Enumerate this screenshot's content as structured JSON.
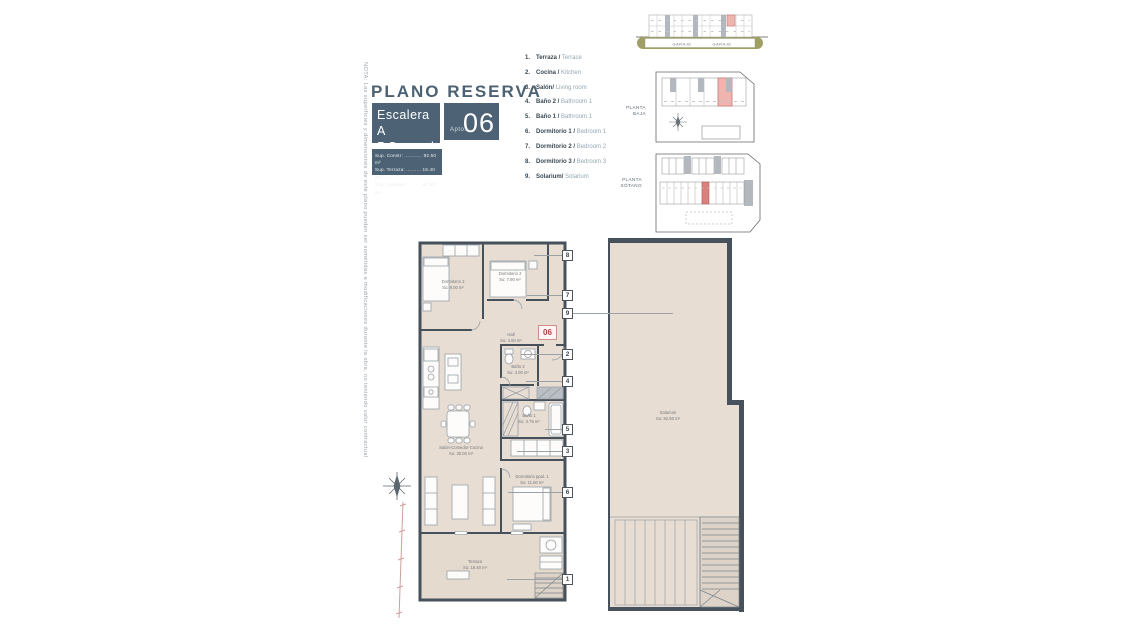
{
  "header": {
    "title": "PLANO RESERVA",
    "escalera": "Escalera A",
    "planta": "P.Segunda",
    "apto_label": "Apto.",
    "apto_number": "06",
    "surface_lines": [
      "Sup. Constr: ............ 92.50 m²",
      "Sup. Terraza: .......... 18.40 m²",
      "Sup. Solarium: ........ 82.50 m²"
    ]
  },
  "note": "NOTA: Las superficies y dimensiones de este plano pueden ser sometidas a modificaciones durante la obra, no teniendo valor contractual",
  "legend": [
    {
      "num": "1.",
      "es": "Terraza /",
      "en": "Terrace"
    },
    {
      "num": "2.",
      "es": "Cocina /",
      "en": "Kitchen"
    },
    {
      "num": "3.",
      "es": "Salón/",
      "en": "Living room"
    },
    {
      "num": "4.",
      "es": "Baño 2 /",
      "en": "Bathroom 1"
    },
    {
      "num": "5.",
      "es": "Baño 1 /",
      "en": "Bathroom 1"
    },
    {
      "num": "6.",
      "es": "Dormitorio 1 /",
      "en": "Bedroom 1"
    },
    {
      "num": "7.",
      "es": "Dormitorio 2 /",
      "en": "Bedroom 2"
    },
    {
      "num": "8.",
      "es": "Dormitorio 3 /",
      "en": "Bedroom 3"
    },
    {
      "num": "9.",
      "es": "Solarium/",
      "en": "Solarium"
    }
  ],
  "minimaps": {
    "baja_l1": "PLANTA",
    "baja_l2": "BAJA",
    "sotano_l1": "PLANTA",
    "sotano_l2": "SÓTANO",
    "garaje_left": "GARAJE",
    "garaje_right": "GARAJE"
  },
  "plan": {
    "badge": "06",
    "rooms": {
      "d3": {
        "name": "Dormitorio 3",
        "area": "Su: 9.00 m²"
      },
      "d2": {
        "name": "Dormitorio 2",
        "area": "Su: 7.90 m²"
      },
      "hall": {
        "name": "Hall",
        "area": "Su: 4.50 m²"
      },
      "b2": {
        "name": "Baño 2",
        "area": "Su: 4.00 m²"
      },
      "b1": {
        "name": "Baño 1",
        "area": "Su: 3.75 m²"
      },
      "salon": {
        "name": "Salón-Comedor-Cocina",
        "area": "Su: 30.00 m²"
      },
      "ppal": {
        "name": "Dormitorio ppal. 1",
        "area": "Su: 11.50 m²"
      },
      "terraza": {
        "name": "Terraza",
        "area": "Su: 18.40 m²"
      },
      "solarium": {
        "name": "Solarium",
        "area": "Su: 82.50 m²"
      }
    },
    "callouts": {
      "c1": "1",
      "c2": "2",
      "c3": "3",
      "c4": "4",
      "c5": "5",
      "c6": "6",
      "c7": "7",
      "c8": "8",
      "c9": "9"
    }
  },
  "colors": {
    "slate": "#4d6375",
    "wall": "#47515b",
    "floor": "#e7ddd3",
    "accent_red": "#b5413f",
    "olive": "#a0a066",
    "highlight_pink": "#f0b4af"
  }
}
